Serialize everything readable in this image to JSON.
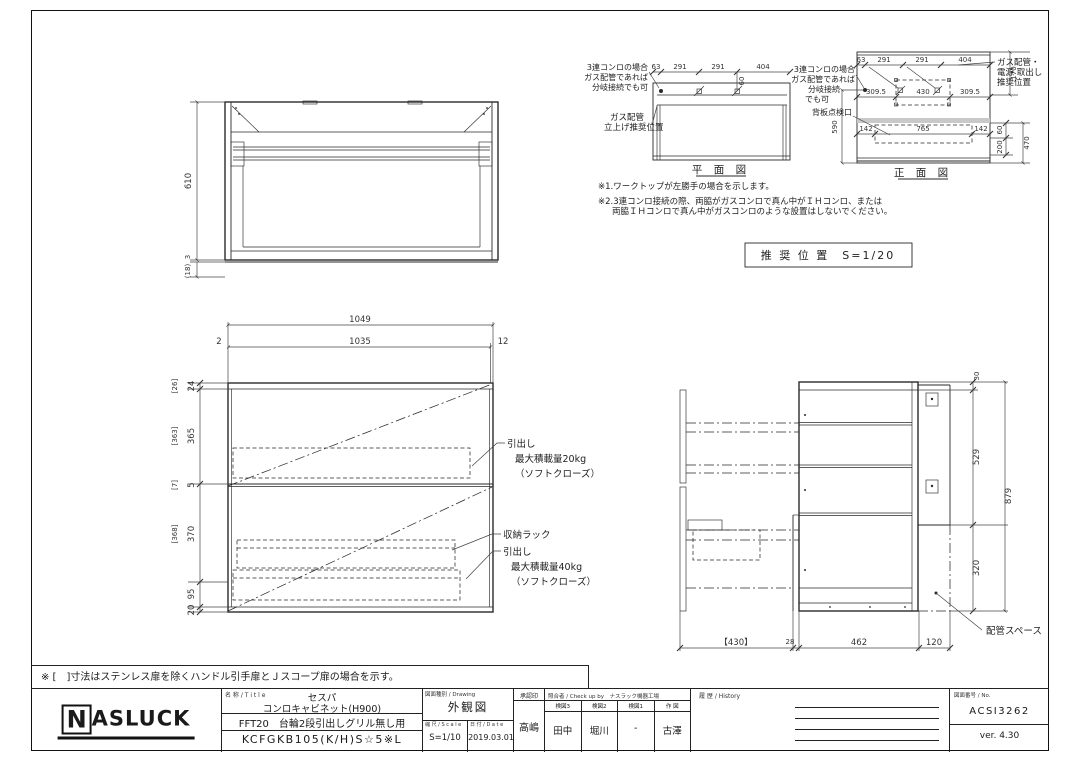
{
  "colors": {
    "line": "#2a2a2a",
    "dim_text": "#333333",
    "gray_band": "#c9c9c9"
  },
  "bracket_note": "※ [　]寸法はステンレス扉を除くハンドル引手扉とＪスコープ扉の場合を示す。",
  "recommended": {
    "box_label": "推 奨 位 置　S=1/20",
    "plan": {
      "caption": "平 面 図",
      "dims_top": [
        "63",
        "291",
        "291",
        "404"
      ],
      "dim_offset": "60",
      "branch_label": [
        "3連コンロの場合",
        "ガス配管であれば",
        "分岐接続でも可"
      ],
      "riser_label": [
        "ガス配管",
        "立上げ推奨位置"
      ],
      "note1": "※1.ワークトップが左勝手の場合を示します。",
      "note2_line1": "※2.3連コンロ接続の際、両脇がガスコンロで真ん中がＩＨコンロ、または",
      "note2_line2": "両脇ＩＨコンロで真ん中がガスコンロのような設置はしないでください。"
    },
    "front": {
      "caption": "正 面 図",
      "dims_top": [
        "63",
        "291",
        "291",
        "404"
      ],
      "dims_mid": [
        "309.5",
        "430",
        "309.5"
      ],
      "dims_access": [
        "142",
        "765",
        "142"
      ],
      "dim_height": "590",
      "dims_right": [
        "170",
        "60",
        "470",
        "200"
      ],
      "branch_label": [
        "3連コンロの場合",
        "ガス配管であれば",
        "分岐接続",
        "でも可"
      ],
      "outlet_label": [
        "ガス配管・",
        "電源 取出し",
        "推奨位置"
      ],
      "access_label": "背板点検口"
    }
  },
  "top_view": {
    "dim_height": "610",
    "dim_lip": "3",
    "dim_overhang": "(18)"
  },
  "front_view": {
    "dim_total_w": "1049",
    "dim_inner_w": "1035",
    "dim_left_gap": "2",
    "dim_right_gap": "12",
    "left_dims": [
      "[26]",
      "24",
      "[363]",
      "365",
      "[7]",
      "5",
      "[368]",
      "370",
      "95",
      "20"
    ],
    "drawer1_label": [
      "引出し",
      "最大積載量20kg",
      "（ソフトクローズ）"
    ],
    "rack_label": "収納ラック",
    "drawer2_label": [
      "引出し",
      "最大積載量40kg",
      "（ソフトクローズ）"
    ]
  },
  "side_view": {
    "dim_top": "30",
    "dim_upper": "529",
    "dim_total_h": "879",
    "dim_lower": "320",
    "dims_bottom": [
      "【430】",
      "28",
      "462",
      "120"
    ],
    "pipe_label": "配管スペース"
  },
  "titleblock": {
    "logo": {
      "first": "N",
      "rest": "ASLUCK"
    },
    "title_header": "名 称 / T i t l e",
    "product_series": "セスパ",
    "product_name": "コンロキャビネット(H900)",
    "product_spec": "FFT20　台輪2段引出しグリル無し用",
    "product_code": "KCFGKB105(K/H)S☆5※L",
    "drawing_header": "図面種別 / Drawing",
    "drawing_type": "外観図",
    "scale_header": "縮 尺 / S c a l e",
    "scale": "S=1/10",
    "date_header": "日 付 / D a t e",
    "date": "2019.03.01",
    "approval_header": "承認印",
    "approval": "高嶋",
    "check_header": "照合者 / Check up by　ナスラック機器工場",
    "check_cols": [
      "検図3",
      "検図2",
      "検図1",
      "作 図"
    ],
    "check_vals": [
      "田中",
      "堀川",
      "-",
      "古澤"
    ],
    "history_header": "履 歴 / History",
    "no_header": "図面番号 / No.",
    "drawing_no": "ACSI3262",
    "version": "ver. 4.30"
  }
}
